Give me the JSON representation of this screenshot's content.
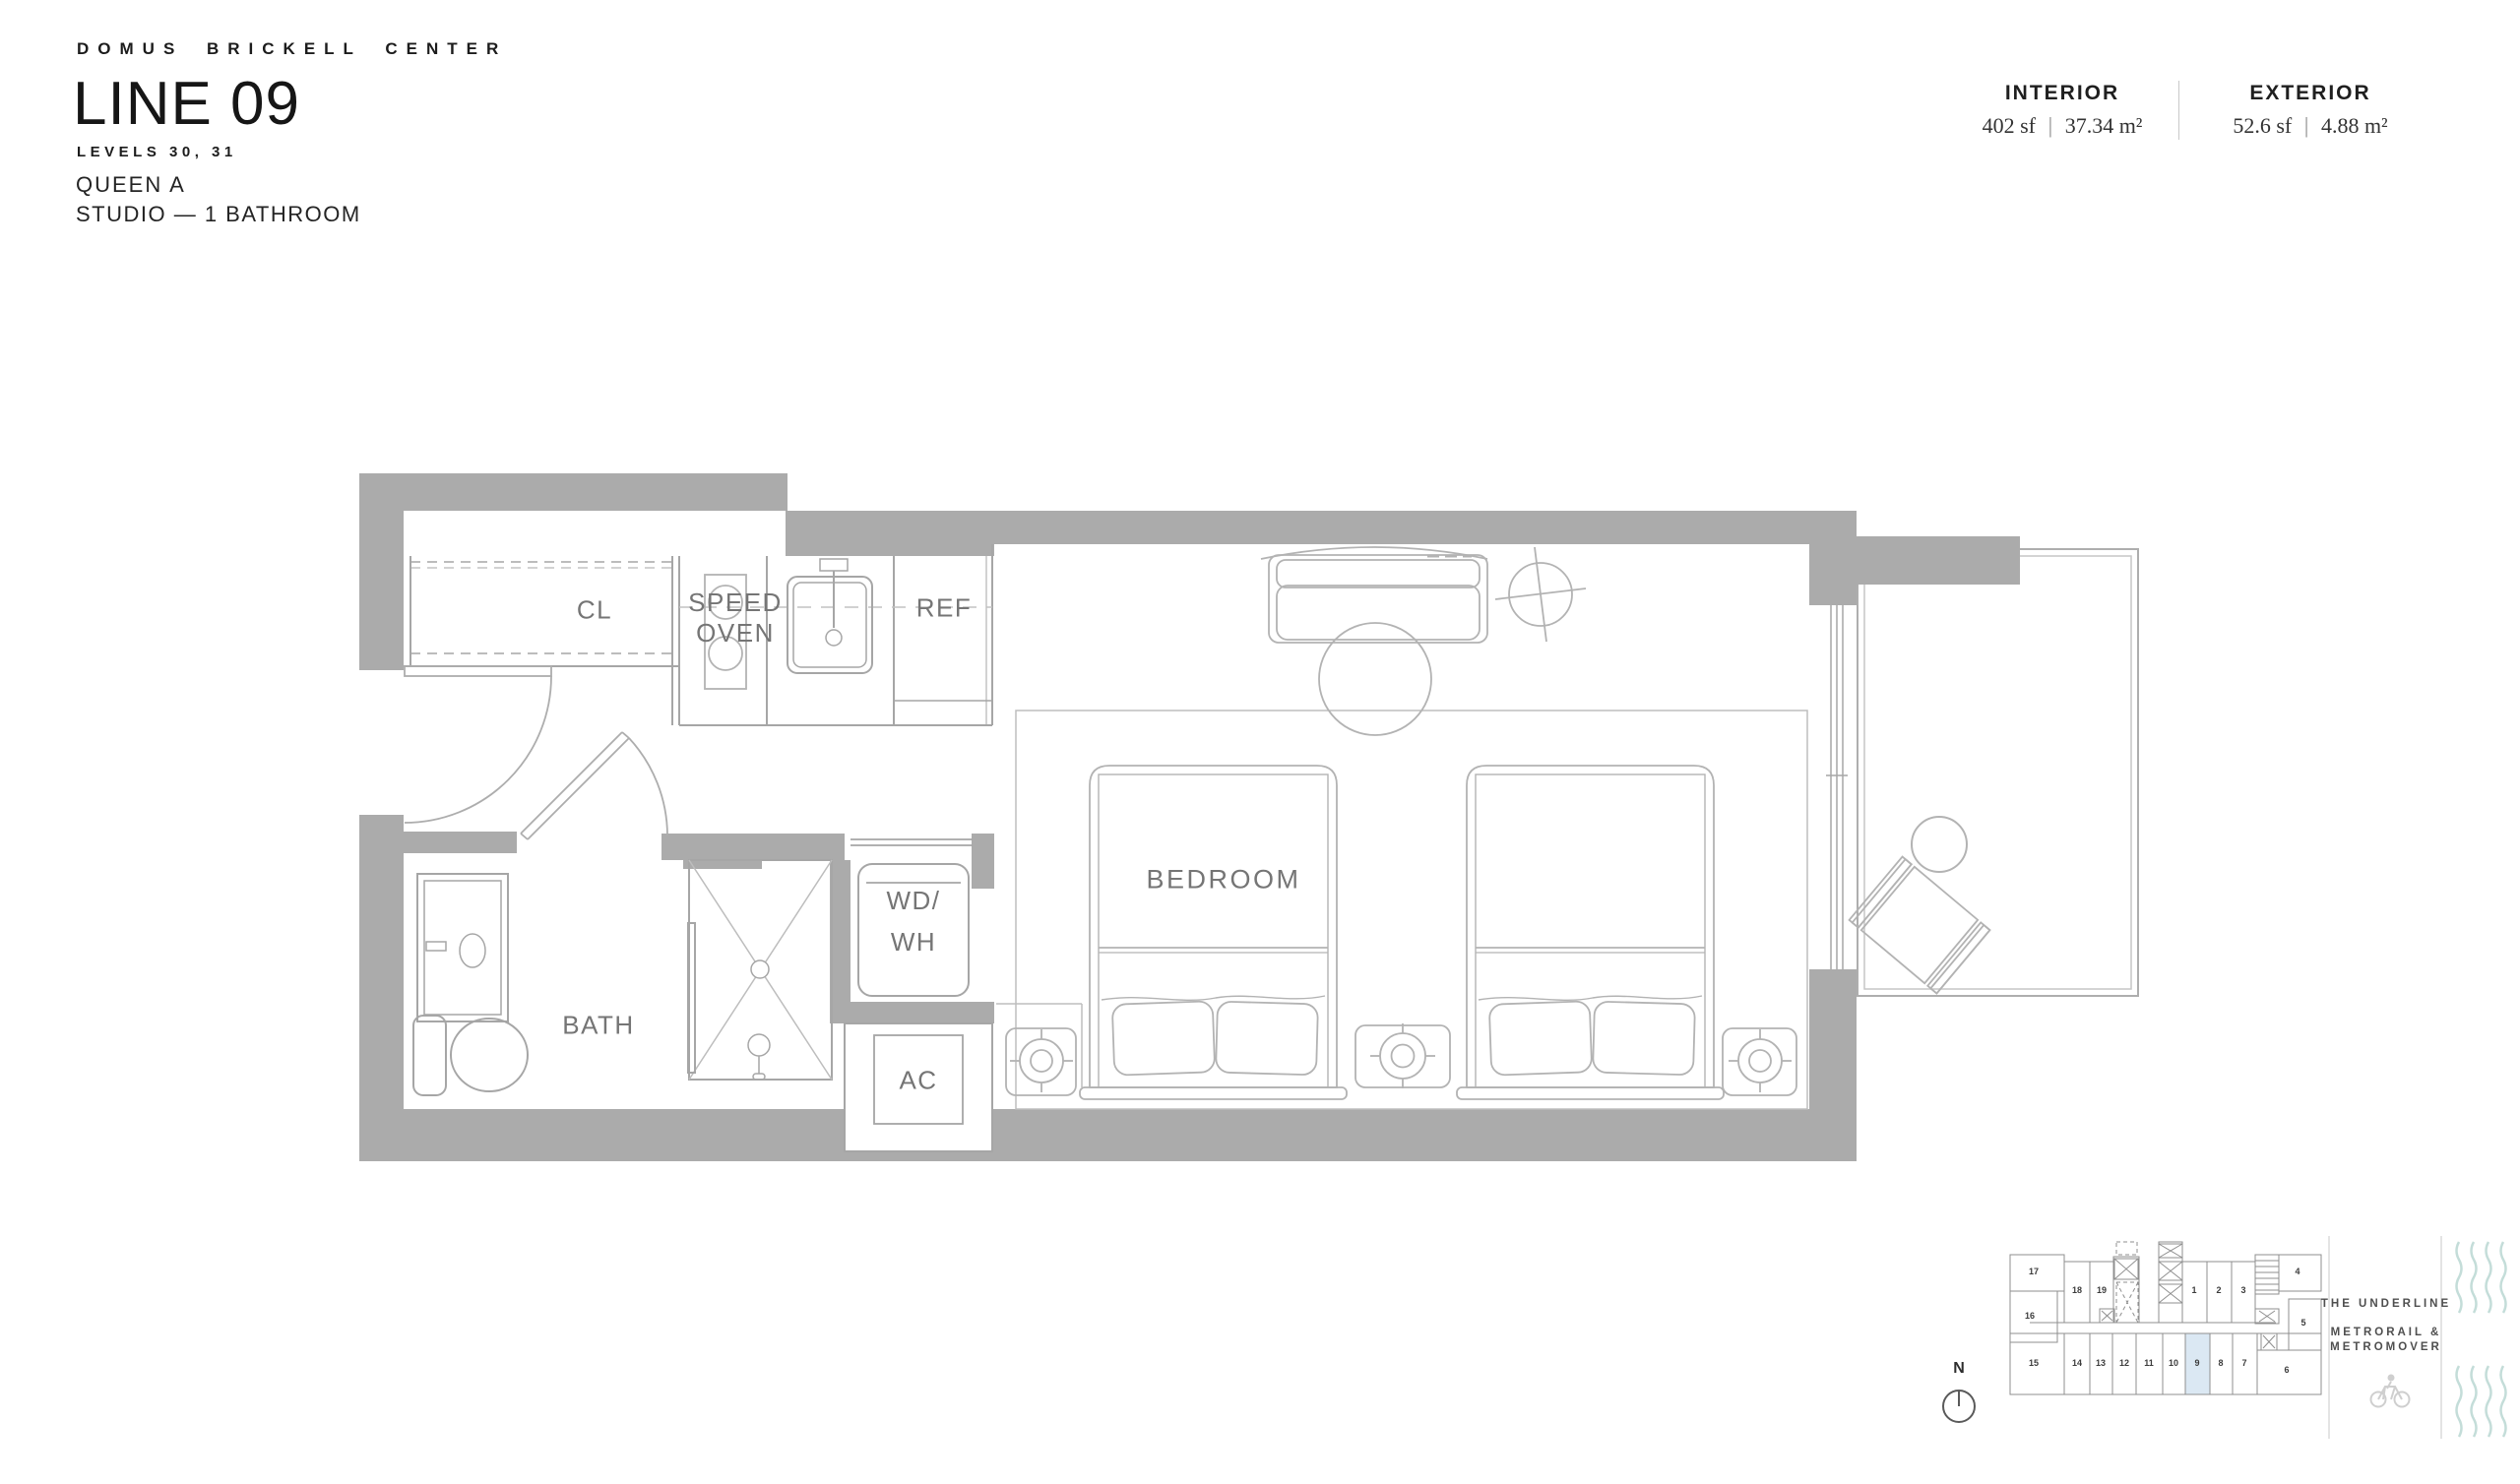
{
  "header": {
    "brand": "DOMUS BRICKELL CENTER",
    "title": "LINE 09",
    "levels": "LEVELS 30, 31",
    "unit_name": "QUEEN A",
    "unit_type": "STUDIO — 1 BATHROOM"
  },
  "areas": {
    "interior": {
      "label": "INTERIOR",
      "imperial": "402 sf",
      "separator": "|",
      "metric": "37.34 m²"
    },
    "exterior": {
      "label": "EXTERIOR",
      "imperial": "52.6 sf",
      "separator": "|",
      "metric": "4.88 m²"
    }
  },
  "plan": {
    "labels": {
      "closet": "CL",
      "speed_oven_line1": "SPEED",
      "speed_oven_line2": "OVEN",
      "fridge": "REF",
      "bedroom": "BEDROOM",
      "bath": "BATH",
      "washer_line1": "WD/",
      "washer_line2": "WH",
      "ac": "AC"
    }
  },
  "keyplan": {
    "north": "N",
    "highlighted_unit": "9",
    "units": {
      "u1": "1",
      "u2": "2",
      "u3": "3",
      "u4": "4",
      "u5": "5",
      "u6": "6",
      "u7": "7",
      "u8": "8",
      "u9": "9",
      "u10": "10",
      "u11": "11",
      "u12": "12",
      "u13": "13",
      "u14": "14",
      "u15": "15",
      "u16": "16",
      "u17": "17",
      "u18": "18",
      "u19": "19"
    },
    "captions": {
      "underline": "THE UNDERLINE",
      "metrorail_line1": "METRORAIL &",
      "metrorail_line2": "METROMOVER"
    }
  },
  "colors": {
    "wall_gray": "#ababab",
    "line_gray": "#a6a6a6",
    "furniture_gray": "#b3b3b3",
    "label_gray": "#757575",
    "highlight_blue": "#dbe8f3",
    "wave_teal": "#c4ddd9",
    "ink": "#1d1d1d"
  }
}
